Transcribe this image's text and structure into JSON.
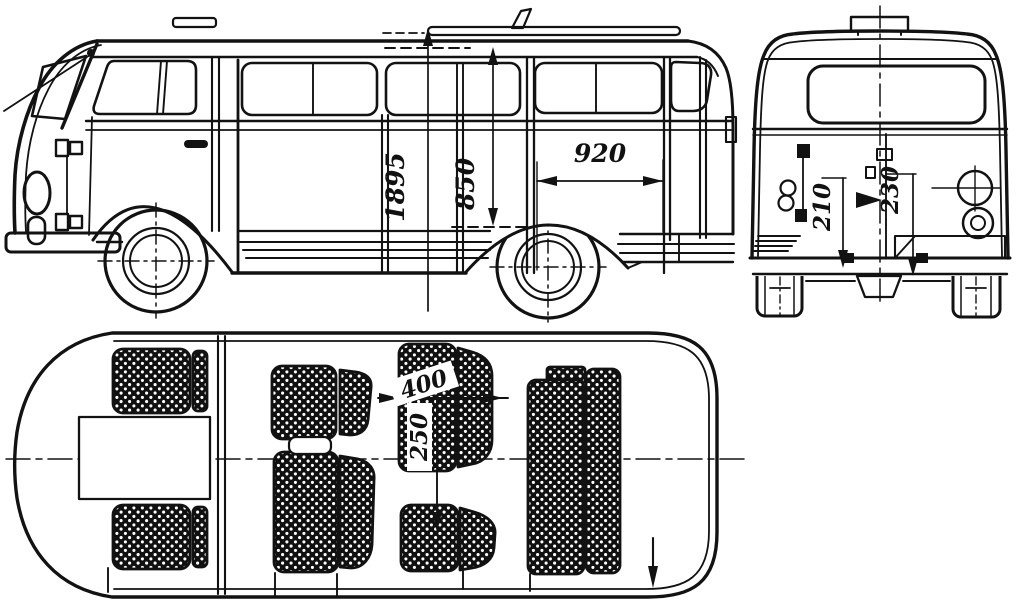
{
  "page": {
    "background": "#ffffff",
    "ink": "#111111"
  },
  "dimensions": {
    "side_view": {
      "overall_height": "1895",
      "interior_height": "850",
      "door_opening_width": "920"
    },
    "rear_view": {
      "dim_left": "210",
      "dim_right": "230"
    },
    "plan_view": {
      "dim_seat": "400",
      "dim_spacing": "250"
    }
  }
}
